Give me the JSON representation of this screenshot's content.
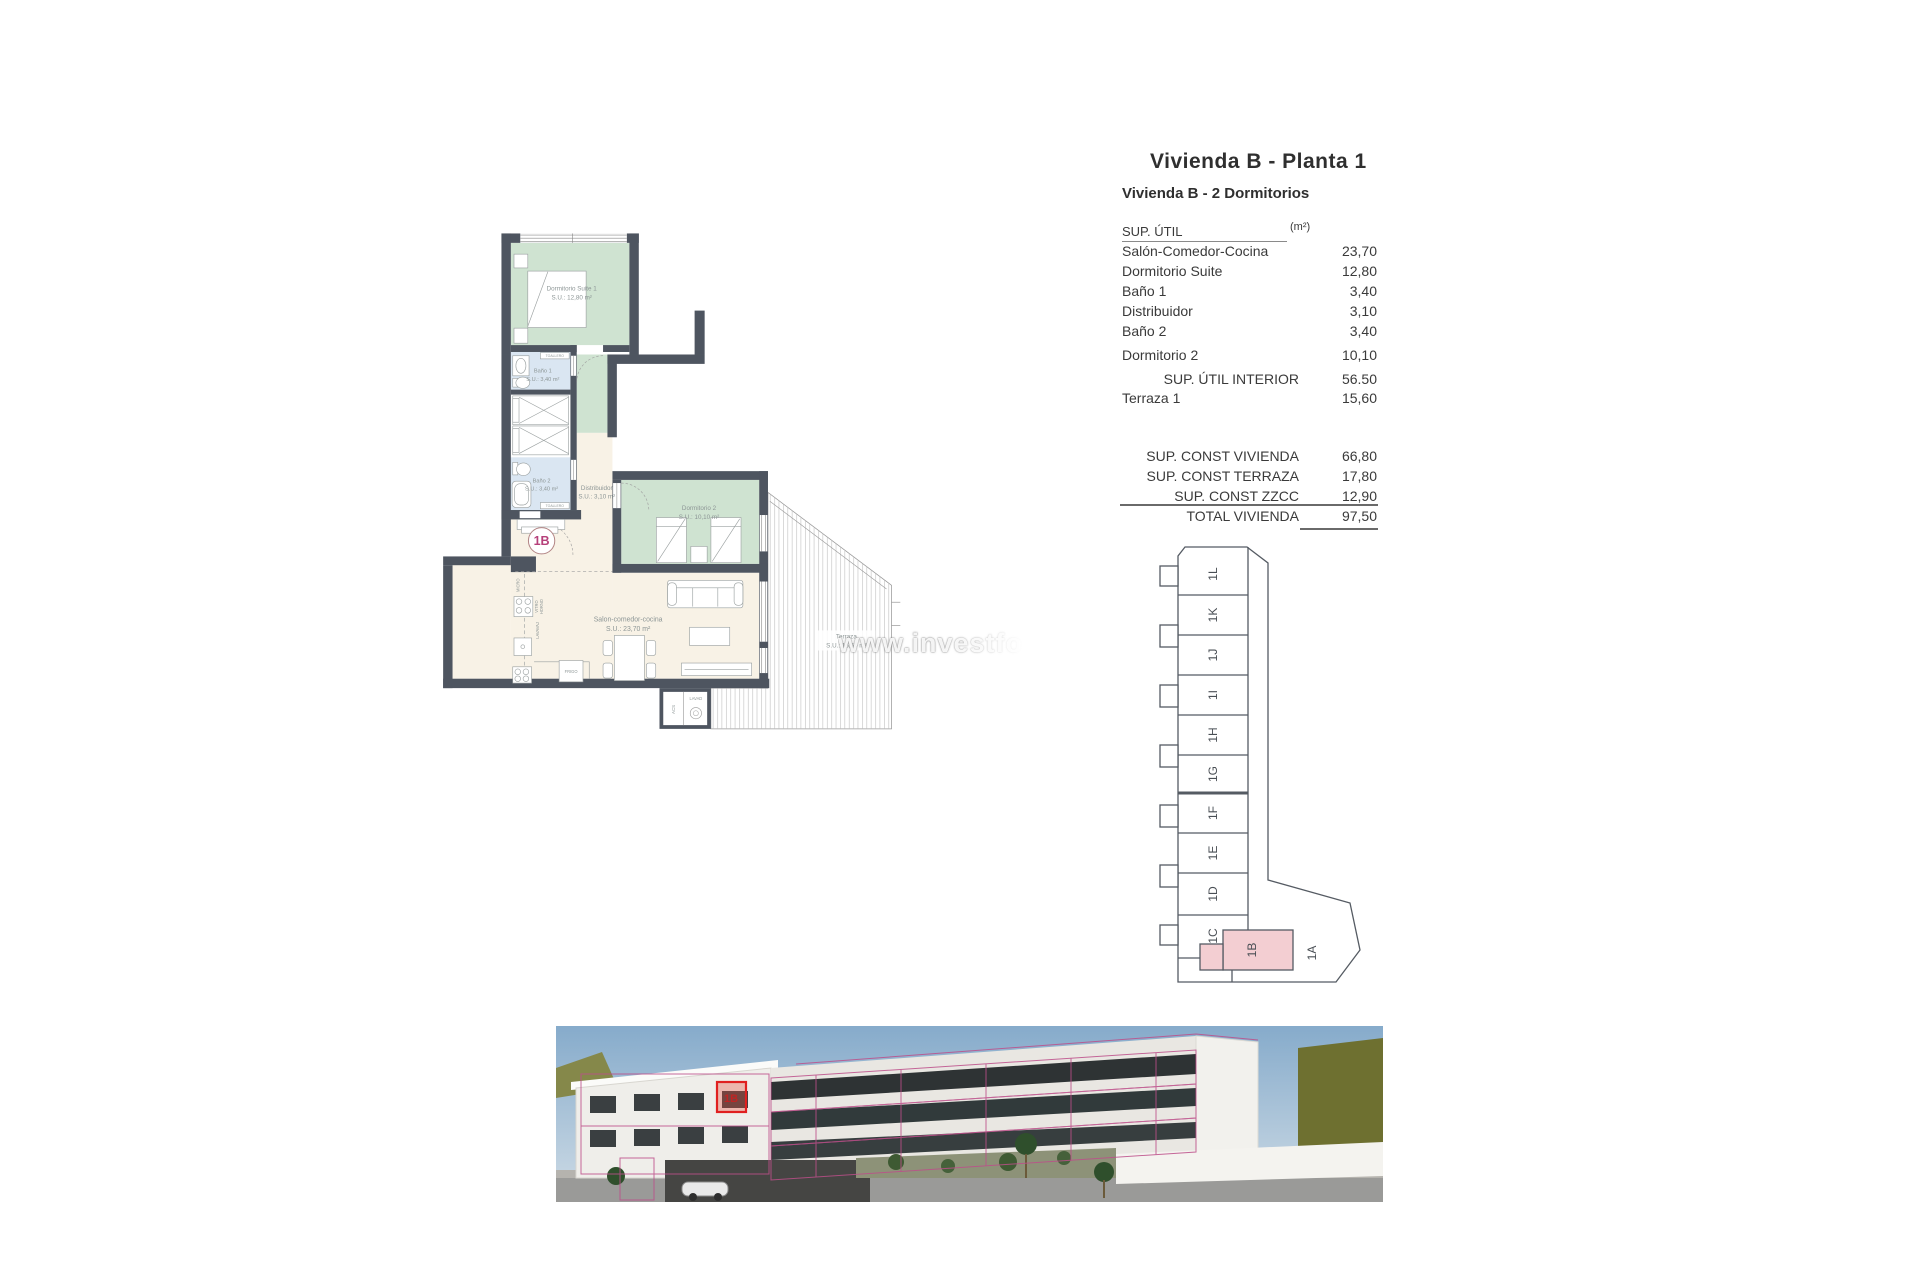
{
  "header": {
    "title": "Vivienda B - Planta 1",
    "subtitle": "Vivienda B - 2 Dormitorios"
  },
  "area_table": {
    "col_header": "SUP. ÚTIL",
    "col_unit": "(m²)",
    "rows": [
      {
        "label": "Salón-Comedor-Cocina",
        "value": "23,70"
      },
      {
        "label": "Dormitorio Suite",
        "value": "12,80"
      },
      {
        "label": "Baño 1",
        "value": "3,40"
      },
      {
        "label": "Distribuidor",
        "value": "3,10"
      },
      {
        "label": "Baño 2",
        "value": "3,40"
      },
      {
        "label": "Dormitorio 2",
        "value": "10,10"
      }
    ],
    "subtotal": {
      "label": "SUP. ÚTIL INTERIOR",
      "value": "56.50"
    },
    "terraza_row": {
      "label": "Terraza 1",
      "value": "15,60"
    },
    "const_rows": [
      {
        "label": "SUP. CONST VIVIENDA",
        "value": "66,80"
      },
      {
        "label": "SUP. CONST TERRAZA",
        "value": "17,80"
      },
      {
        "label": "SUP. CONST ZZCC",
        "value": "12,90"
      }
    ],
    "total": {
      "label": "TOTAL VIVIENDA",
      "value": "97,50"
    }
  },
  "plan": {
    "unit_badge": "1B",
    "rooms": {
      "suite": {
        "name": "Dormitorio Suite 1",
        "area": "S.U.: 12,80 m²"
      },
      "bano1": {
        "name": "Baño 1",
        "area": "S.U.: 3,40 m²"
      },
      "bano2": {
        "name": "Baño 2",
        "area": "S.U.: 3,40 m²"
      },
      "distribuidor": {
        "name": "Distribuidor",
        "area": "S.U.: 3,10 m²"
      },
      "dorm2": {
        "name": "Dormitorio 2",
        "area": "S.U.: 10,10 m²"
      },
      "salon": {
        "name": "Salon-comedor-cocina",
        "area": "S.U.: 23,70 m²"
      },
      "terraza": {
        "name": "Terraza",
        "area": "S.U.: 15,60 m²"
      }
    },
    "fixtures": {
      "toallero": "TOALLERO",
      "micro": "MICRO",
      "vitro": "VITRO",
      "horno": "HORNO",
      "lavavaj": "LAVAVAJ",
      "frigo": "FRIGO",
      "acs": "ACS",
      "lavad": "LAVAD"
    }
  },
  "keyplan": {
    "units": [
      "1L",
      "1K",
      "1J",
      "1I",
      "1H",
      "1G",
      "1F",
      "1E",
      "1D",
      "1C"
    ],
    "highlight": "1B",
    "adjacent": "1A"
  },
  "photo": {
    "marker": "1B"
  },
  "watermark": "www.investfo",
  "colors": {
    "wall": "#4e5560",
    "room_green": "#cfe3d1",
    "room_blue": "#dae6f2",
    "floor_beige": "#f8f2e6",
    "keyplan_pink": "#f3ced2",
    "badge_pink": "#b6407a",
    "marker_red": "#e02020"
  }
}
